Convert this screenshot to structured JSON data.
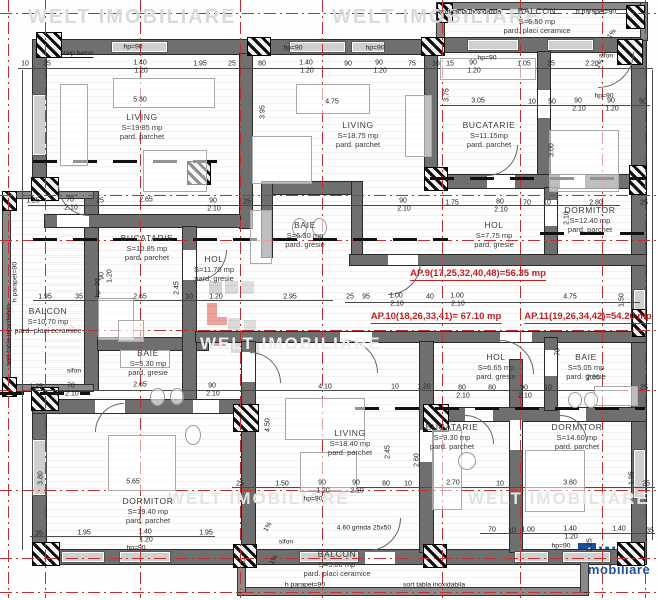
{
  "colors": {
    "accent_red": "#c21f1f",
    "wall_gray": "#6f6f6f",
    "logo_blue": "#1c4ea1",
    "watermark_gray": "#dadada"
  },
  "logo": {
    "brand": "welt",
    "sub": "imobiliare",
    "check": "✓"
  },
  "watermark_texts": [
    {
      "t": "WELT IMOBILIARE",
      "x": 28,
      "y": 6,
      "s": 20,
      "c": "#dadada"
    },
    {
      "t": "WELT IMOBILIARE",
      "x": 332,
      "y": 6,
      "s": 20,
      "c": "#dadada"
    },
    {
      "t": "WELT IMOBILIARE",
      "x": 200,
      "y": 334,
      "s": 17,
      "c": "#ededed"
    },
    {
      "t": "WELT IMOBILIARE",
      "x": 168,
      "y": 489,
      "s": 17,
      "c": "#e3e3e3"
    },
    {
      "t": "WELT IMOBILIARE",
      "x": 468,
      "y": 489,
      "s": 17,
      "c": "#e3e3e3"
    }
  ],
  "apartments": [
    {
      "label": "AP.9(17,25,32,40,48)=56.35 mp",
      "x": 478,
      "y": 268
    },
    {
      "label": "AP.10(18,26,33,41)= 67.10 mp",
      "x": 436,
      "y": 311
    },
    {
      "label": "AP.11(19,26,34,42)=54.20 mp",
      "x": 588,
      "y": 311
    }
  ],
  "rooms": [
    {
      "name": "LIVING",
      "area": "S=19.85 mp",
      "floor": "pard. parchet",
      "x": 142,
      "y": 112
    },
    {
      "name": "LIVING",
      "area": "S=18.75 mp",
      "floor": "pard. parchet",
      "x": 358,
      "y": 120
    },
    {
      "name": "BUCATARIE",
      "area": "S=11.15mp",
      "floor": "pard. parchet",
      "x": 489,
      "y": 120
    },
    {
      "name": "BALCON",
      "area": "S=6.50 mp",
      "floor": "pard. placi ceramice",
      "x": 537,
      "y": 6
    },
    {
      "name": "DORMITOR",
      "area": "S=12.40 mp",
      "floor": "pard. parchet",
      "x": 590,
      "y": 205
    },
    {
      "name": "HOL",
      "area": "S=7.75 mp",
      "floor": "pard. gresie",
      "x": 494,
      "y": 220
    },
    {
      "name": "BUCATARIE",
      "area": "S=10.85 mp",
      "floor": "pard. parchet",
      "x": 147,
      "y": 233
    },
    {
      "name": "HOL",
      "area": "S=11.70 mp",
      "floor": "pard. gresie",
      "x": 214,
      "y": 254
    },
    {
      "name": "BAIE",
      "area": "S=6.30 mp",
      "floor": "pard. gresie",
      "x": 305,
      "y": 220
    },
    {
      "name": "BALCON",
      "area": "S=10.70 mp",
      "floor": "pard. placi ceramice",
      "x": 48,
      "y": 306
    },
    {
      "name": "BAIE",
      "area": "S=5.30 mp",
      "floor": "pard. gresie",
      "x": 148,
      "y": 348
    },
    {
      "name": "LIVING",
      "area": "S=18.40 mp",
      "floor": "pard. parchet",
      "x": 350,
      "y": 428
    },
    {
      "name": "BUCATARIE",
      "area": "S=9.30 mp",
      "floor": "pard. parchet",
      "x": 452,
      "y": 422
    },
    {
      "name": "HOL",
      "area": "S=6.65 mp",
      "floor": "pard. gresie",
      "x": 496,
      "y": 352
    },
    {
      "name": "BAIE",
      "area": "S=5.05 mp",
      "floor": "pard. gresie",
      "x": 586,
      "y": 352
    },
    {
      "name": "DORMITOR",
      "area": "S=14.60 mp",
      "floor": "pard. parchet",
      "x": 577,
      "y": 422
    },
    {
      "name": "DORMITOR",
      "area": "S=19.40 mp",
      "floor": "pard. parchet",
      "x": 148,
      "y": 496
    },
    {
      "name": "BALCON",
      "area": "S=9.00 mp",
      "floor": "pard. placi ceramice",
      "x": 337,
      "y": 549
    }
  ],
  "annotations": [
    {
      "t": "stalp beton",
      "x": 77,
      "y": 54,
      "u": true
    },
    {
      "t": "sort tabla inoxidabila",
      "x": 470,
      "y": 12
    },
    {
      "t": "h parapet=90",
      "x": 596,
      "y": 12
    },
    {
      "t": "sifon",
      "x": 606,
      "y": 56
    },
    {
      "t": "sifon",
      "x": 74,
      "y": 371
    },
    {
      "t": "sifon",
      "x": 286,
      "y": 542
    },
    {
      "t": "hp=90",
      "x": 133,
      "y": 47
    },
    {
      "t": "hp=90",
      "x": 293,
      "y": 48
    },
    {
      "t": "hp=90",
      "x": 375,
      "y": 48
    },
    {
      "t": "hp=90",
      "x": 487,
      "y": 58
    },
    {
      "t": "hp=90",
      "x": 604,
      "y": 96
    },
    {
      "t": "hp=90",
      "x": 313,
      "y": 499
    },
    {
      "t": "hp=90",
      "x": 136,
      "y": 548
    },
    {
      "t": "hp=90",
      "x": 561,
      "y": 546
    },
    {
      "t": "h parapet=90",
      "x": 15,
      "y": 282,
      "v": true
    },
    {
      "t": "sort tabla inoxidabila",
      "x": 9,
      "y": 335,
      "v": true
    },
    {
      "t": "hp=90",
      "x": 98,
      "y": 288,
      "v": true
    },
    {
      "t": "h parapet=90",
      "x": 305,
      "y": 585
    },
    {
      "t": "sort tabla inoxidabila",
      "x": 434,
      "y": 585
    },
    {
      "t": "4.60 grinda 25x50",
      "x": 364,
      "y": 528
    },
    {
      "t": "1%",
      "x": 612,
      "y": 34,
      "r": -55
    },
    {
      "t": "1%",
      "x": 600,
      "y": 64,
      "r": -55
    },
    {
      "t": "1%",
      "x": 268,
      "y": 527,
      "r": -60
    },
    {
      "t": "1%",
      "x": 274,
      "y": 560,
      "r": -60
    }
  ],
  "dimensions": [
    {
      "t": "10",
      "x": 25,
      "y": 64
    },
    {
      "t": "25",
      "x": 47,
      "y": 64
    },
    {
      "t": "1.40",
      "x": 140,
      "y": 63
    },
    {
      "t": "1.20",
      "x": 141,
      "y": 71
    },
    {
      "t": "1.95",
      "x": 200,
      "y": 64
    },
    {
      "t": "25",
      "x": 232,
      "y": 64
    },
    {
      "t": "80",
      "x": 262,
      "y": 64
    },
    {
      "t": "1.40",
      "x": 306,
      "y": 63
    },
    {
      "t": "1.20",
      "x": 307,
      "y": 71
    },
    {
      "t": "90",
      "x": 348,
      "y": 64
    },
    {
      "t": "90",
      "x": 379,
      "y": 63
    },
    {
      "t": "1.20",
      "x": 380,
      "y": 71
    },
    {
      "t": "75",
      "x": 412,
      "y": 64
    },
    {
      "t": "16",
      "x": 436,
      "y": 64
    },
    {
      "t": "15",
      "x": 450,
      "y": 64
    },
    {
      "t": "90",
      "x": 473,
      "y": 63
    },
    {
      "t": "1.20",
      "x": 474,
      "y": 71
    },
    {
      "t": "1.05",
      "x": 524,
      "y": 64
    },
    {
      "t": "35",
      "x": 551,
      "y": 64
    },
    {
      "t": "2.20",
      "x": 592,
      "y": 64
    },
    {
      "t": "5.30",
      "x": 140,
      "y": 100
    },
    {
      "t": "4.75",
      "x": 332,
      "y": 102
    },
    {
      "t": "3.95",
      "x": 263,
      "y": 112,
      "v": 1
    },
    {
      "t": "3.75",
      "x": 447,
      "y": 95,
      "v": 1
    },
    {
      "t": "3.00",
      "x": 552,
      "y": 150,
      "v": 1
    },
    {
      "t": "3.05",
      "x": 478,
      "y": 101
    },
    {
      "t": "10",
      "x": 532,
      "y": 102
    },
    {
      "t": "50",
      "x": 552,
      "y": 102
    },
    {
      "t": "90",
      "x": 578,
      "y": 101
    },
    {
      "t": "2.10",
      "x": 579,
      "y": 109
    },
    {
      "t": "90",
      "x": 611,
      "y": 101
    },
    {
      "t": "1.20",
      "x": 612,
      "y": 109
    },
    {
      "t": "50",
      "x": 643,
      "y": 102
    },
    {
      "t": "1.25",
      "x": 33,
      "y": 201
    },
    {
      "t": "70",
      "x": 70,
      "y": 200
    },
    {
      "t": "2.10",
      "x": 71,
      "y": 208
    },
    {
      "t": "25",
      "x": 100,
      "y": 201
    },
    {
      "t": "2.65",
      "x": 146,
      "y": 200
    },
    {
      "t": "90",
      "x": 213,
      "y": 201
    },
    {
      "t": "2.10",
      "x": 214,
      "y": 209
    },
    {
      "t": "25",
      "x": 247,
      "y": 202
    },
    {
      "t": "90",
      "x": 403,
      "y": 201
    },
    {
      "t": "2.10",
      "x": 404,
      "y": 209
    },
    {
      "t": "1.75",
      "x": 452,
      "y": 203
    },
    {
      "t": "80",
      "x": 500,
      "y": 202
    },
    {
      "t": "2.10",
      "x": 501,
      "y": 210
    },
    {
      "t": "70",
      "x": 527,
      "y": 203
    },
    {
      "t": "10",
      "x": 547,
      "y": 203
    },
    {
      "t": "2.80",
      "x": 596,
      "y": 203
    },
    {
      "t": "25",
      "x": 644,
      "y": 203
    },
    {
      "t": "90",
      "x": 102,
      "y": 276,
      "v": 1
    },
    {
      "t": "1.20",
      "x": 110,
      "y": 276,
      "v": 1
    },
    {
      "t": "2.45",
      "x": 177,
      "y": 288,
      "v": 1
    },
    {
      "t": "2.10",
      "x": 567,
      "y": 218,
      "v": 1
    },
    {
      "t": "1.95",
      "x": 45,
      "y": 297
    },
    {
      "t": "35",
      "x": 79,
      "y": 297
    },
    {
      "t": "2.65",
      "x": 140,
      "y": 297
    },
    {
      "t": "10",
      "x": 189,
      "y": 297
    },
    {
      "t": "1.20",
      "x": 216,
      "y": 297
    },
    {
      "t": "2.95",
      "x": 290,
      "y": 297
    },
    {
      "t": "25",
      "x": 350,
      "y": 297
    },
    {
      "t": "95",
      "x": 366,
      "y": 297
    },
    {
      "t": "1.00",
      "x": 396,
      "y": 296
    },
    {
      "t": "2.10",
      "x": 397,
      "y": 304
    },
    {
      "t": "40",
      "x": 430,
      "y": 297
    },
    {
      "t": "1.00",
      "x": 457,
      "y": 296
    },
    {
      "t": "2.10",
      "x": 458,
      "y": 304
    },
    {
      "t": "4.75",
      "x": 570,
      "y": 297
    },
    {
      "t": "1.50",
      "x": 622,
      "y": 300,
      "v": 1
    },
    {
      "t": "1.25",
      "x": 36,
      "y": 387
    },
    {
      "t": "70",
      "x": 71,
      "y": 386
    },
    {
      "t": "2.10",
      "x": 72,
      "y": 394
    },
    {
      "t": "2.65",
      "x": 140,
      "y": 385
    },
    {
      "t": "90",
      "x": 212,
      "y": 386
    },
    {
      "t": "2.10",
      "x": 213,
      "y": 394
    },
    {
      "t": "4.10",
      "x": 325,
      "y": 387
    },
    {
      "t": "10",
      "x": 395,
      "y": 387
    },
    {
      "t": "1.20",
      "x": 424,
      "y": 387
    },
    {
      "t": "80",
      "x": 462,
      "y": 388
    },
    {
      "t": "2.10",
      "x": 463,
      "y": 396
    },
    {
      "t": "80",
      "x": 492,
      "y": 388
    },
    {
      "t": "90",
      "x": 524,
      "y": 388
    },
    {
      "t": "2.10",
      "x": 525,
      "y": 396
    },
    {
      "t": "10",
      "x": 548,
      "y": 388
    },
    {
      "t": "2.80",
      "x": 593,
      "y": 378
    },
    {
      "t": "25",
      "x": 644,
      "y": 388
    },
    {
      "t": "70",
      "x": 558,
      "y": 352,
      "v": 1
    },
    {
      "t": "5.65",
      "x": 133,
      "y": 482
    },
    {
      "t": "3.80",
      "x": 41,
      "y": 478,
      "v": 1
    },
    {
      "t": "4.50",
      "x": 268,
      "y": 425,
      "v": 1
    },
    {
      "t": "2.45",
      "x": 388,
      "y": 452,
      "v": 1
    },
    {
      "t": "2.60",
      "x": 417,
      "y": 460,
      "v": 1
    },
    {
      "t": "25",
      "x": 240,
      "y": 484
    },
    {
      "t": "1.50",
      "x": 282,
      "y": 484
    },
    {
      "t": "90",
      "x": 322,
      "y": 483
    },
    {
      "t": "1.20",
      "x": 323,
      "y": 491
    },
    {
      "t": "90",
      "x": 356,
      "y": 483
    },
    {
      "t": "2.10",
      "x": 357,
      "y": 491
    },
    {
      "t": "80",
      "x": 386,
      "y": 484
    },
    {
      "t": "10",
      "x": 408,
      "y": 484
    },
    {
      "t": "2.70",
      "x": 453,
      "y": 483
    },
    {
      "t": "10",
      "x": 500,
      "y": 484
    },
    {
      "t": "3.80",
      "x": 570,
      "y": 483
    },
    {
      "t": "1.95",
      "x": 632,
      "y": 478,
      "v": 1
    },
    {
      "t": "25",
      "x": 646,
      "y": 484
    },
    {
      "t": "35",
      "x": 39,
      "y": 534
    },
    {
      "t": "1.95",
      "x": 84,
      "y": 533
    },
    {
      "t": "1.40",
      "x": 145,
      "y": 532
    },
    {
      "t": "1.20",
      "x": 146,
      "y": 540
    },
    {
      "t": "1.95",
      "x": 206,
      "y": 533
    },
    {
      "t": "70",
      "x": 492,
      "y": 530
    },
    {
      "t": "10",
      "x": 512,
      "y": 531
    },
    {
      "t": "1.00",
      "x": 528,
      "y": 530
    },
    {
      "t": "1.40",
      "x": 570,
      "y": 529
    },
    {
      "t": "1.20",
      "x": 571,
      "y": 537
    },
    {
      "t": "1.40",
      "x": 619,
      "y": 529
    },
    {
      "t": "35",
      "x": 650,
      "y": 531
    },
    {
      "t": "1.25",
      "x": 590,
      "y": 545,
      "v": 1
    },
    {
      "t": "60",
      "x": 244,
      "y": 562,
      "v": 1
    }
  ]
}
